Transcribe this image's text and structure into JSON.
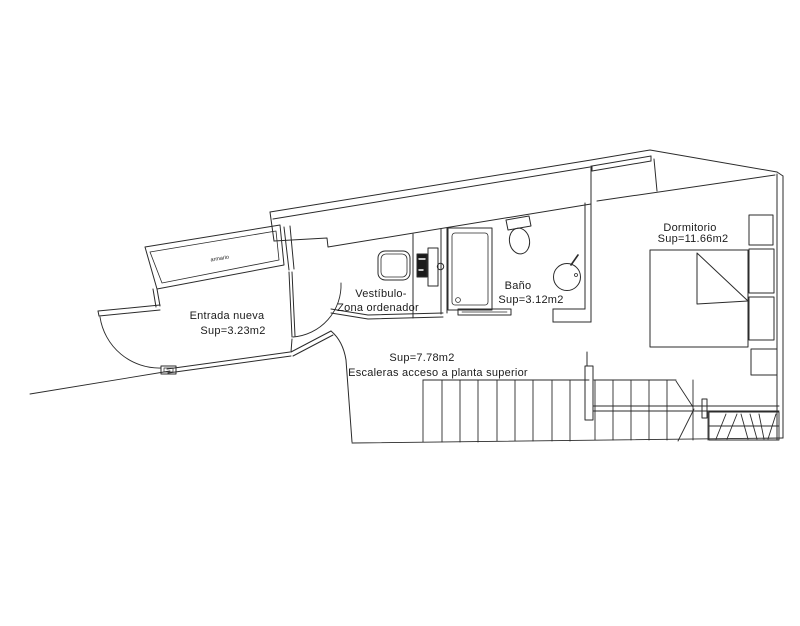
{
  "drawing": {
    "type": "architectural floor plan",
    "labels": {
      "entrada": {
        "line1": "Entrada nueva",
        "line2": "Sup=3.23m2"
      },
      "vestibulo": {
        "line1": "Vestíbulo-",
        "line2": "Zona ordenador"
      },
      "bano": {
        "line1": "Baño",
        "line2": "Sup=3.12m2"
      },
      "dormitorio": {
        "line1": "Dormitorio",
        "line2": "Sup=11.66m2"
      },
      "escaleras": {
        "line1": "Sup=7.78m2",
        "line2": "Escaleras acceso a planta superior"
      },
      "armario": {
        "line1": "armario"
      }
    },
    "colors": {
      "line": "#2b2b2b",
      "background": "#ffffff",
      "text": "#1c1c1c"
    }
  }
}
